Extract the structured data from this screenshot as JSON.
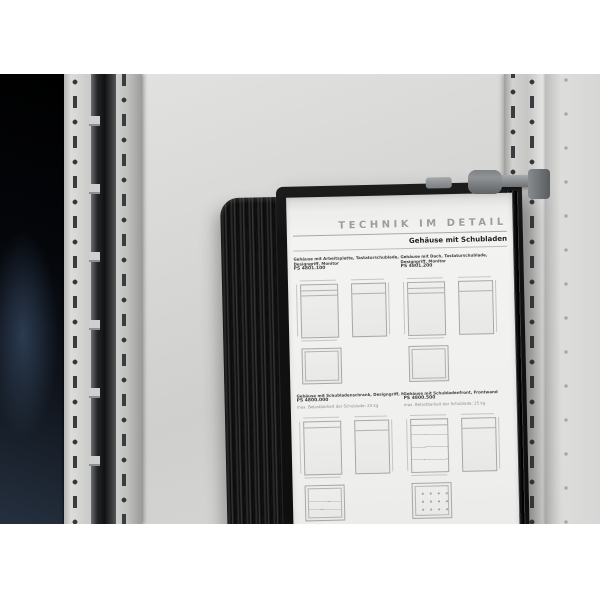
{
  "colors": {
    "wall": "#d6d6d4",
    "rail": "#c9cac8",
    "interior_shadow": "#0a0e14",
    "holder_black": "#141414",
    "bracket_gray": "#7c8083",
    "page": "#f1f1ef"
  },
  "document": {
    "title": "TECHNIK IM DETAIL",
    "subtitle": "Gehäuse mit Schubladen",
    "sections": [
      {
        "line1": "Gehäuse mit Arbeitsplatte, Tastaturschublade,",
        "line2": "Designgriff, Monitor",
        "model": "PS 4801.100",
        "note": ""
      },
      {
        "line1": "Gehäuse mit Dach, Tastaturschublade,",
        "line2": "Designgriff, Monitor",
        "model": "PS 4801.200",
        "note": ""
      },
      {
        "line1": "Gehäuse mit Schubladenschrank, Designgriff, Monitor",
        "line2": "",
        "model": "PS 4800.000",
        "note": "max. Belastbarkeit der Schublade: 25 kg"
      },
      {
        "line1": "Gehäuse mit Schubladenfront, Frontwand",
        "line2": "",
        "model": "PS 4800.500",
        "note": "max. Belastbarkeit der Schublade: 25 kg"
      }
    ],
    "footer_left": "■ Rittal",
    "page_number": "45"
  }
}
